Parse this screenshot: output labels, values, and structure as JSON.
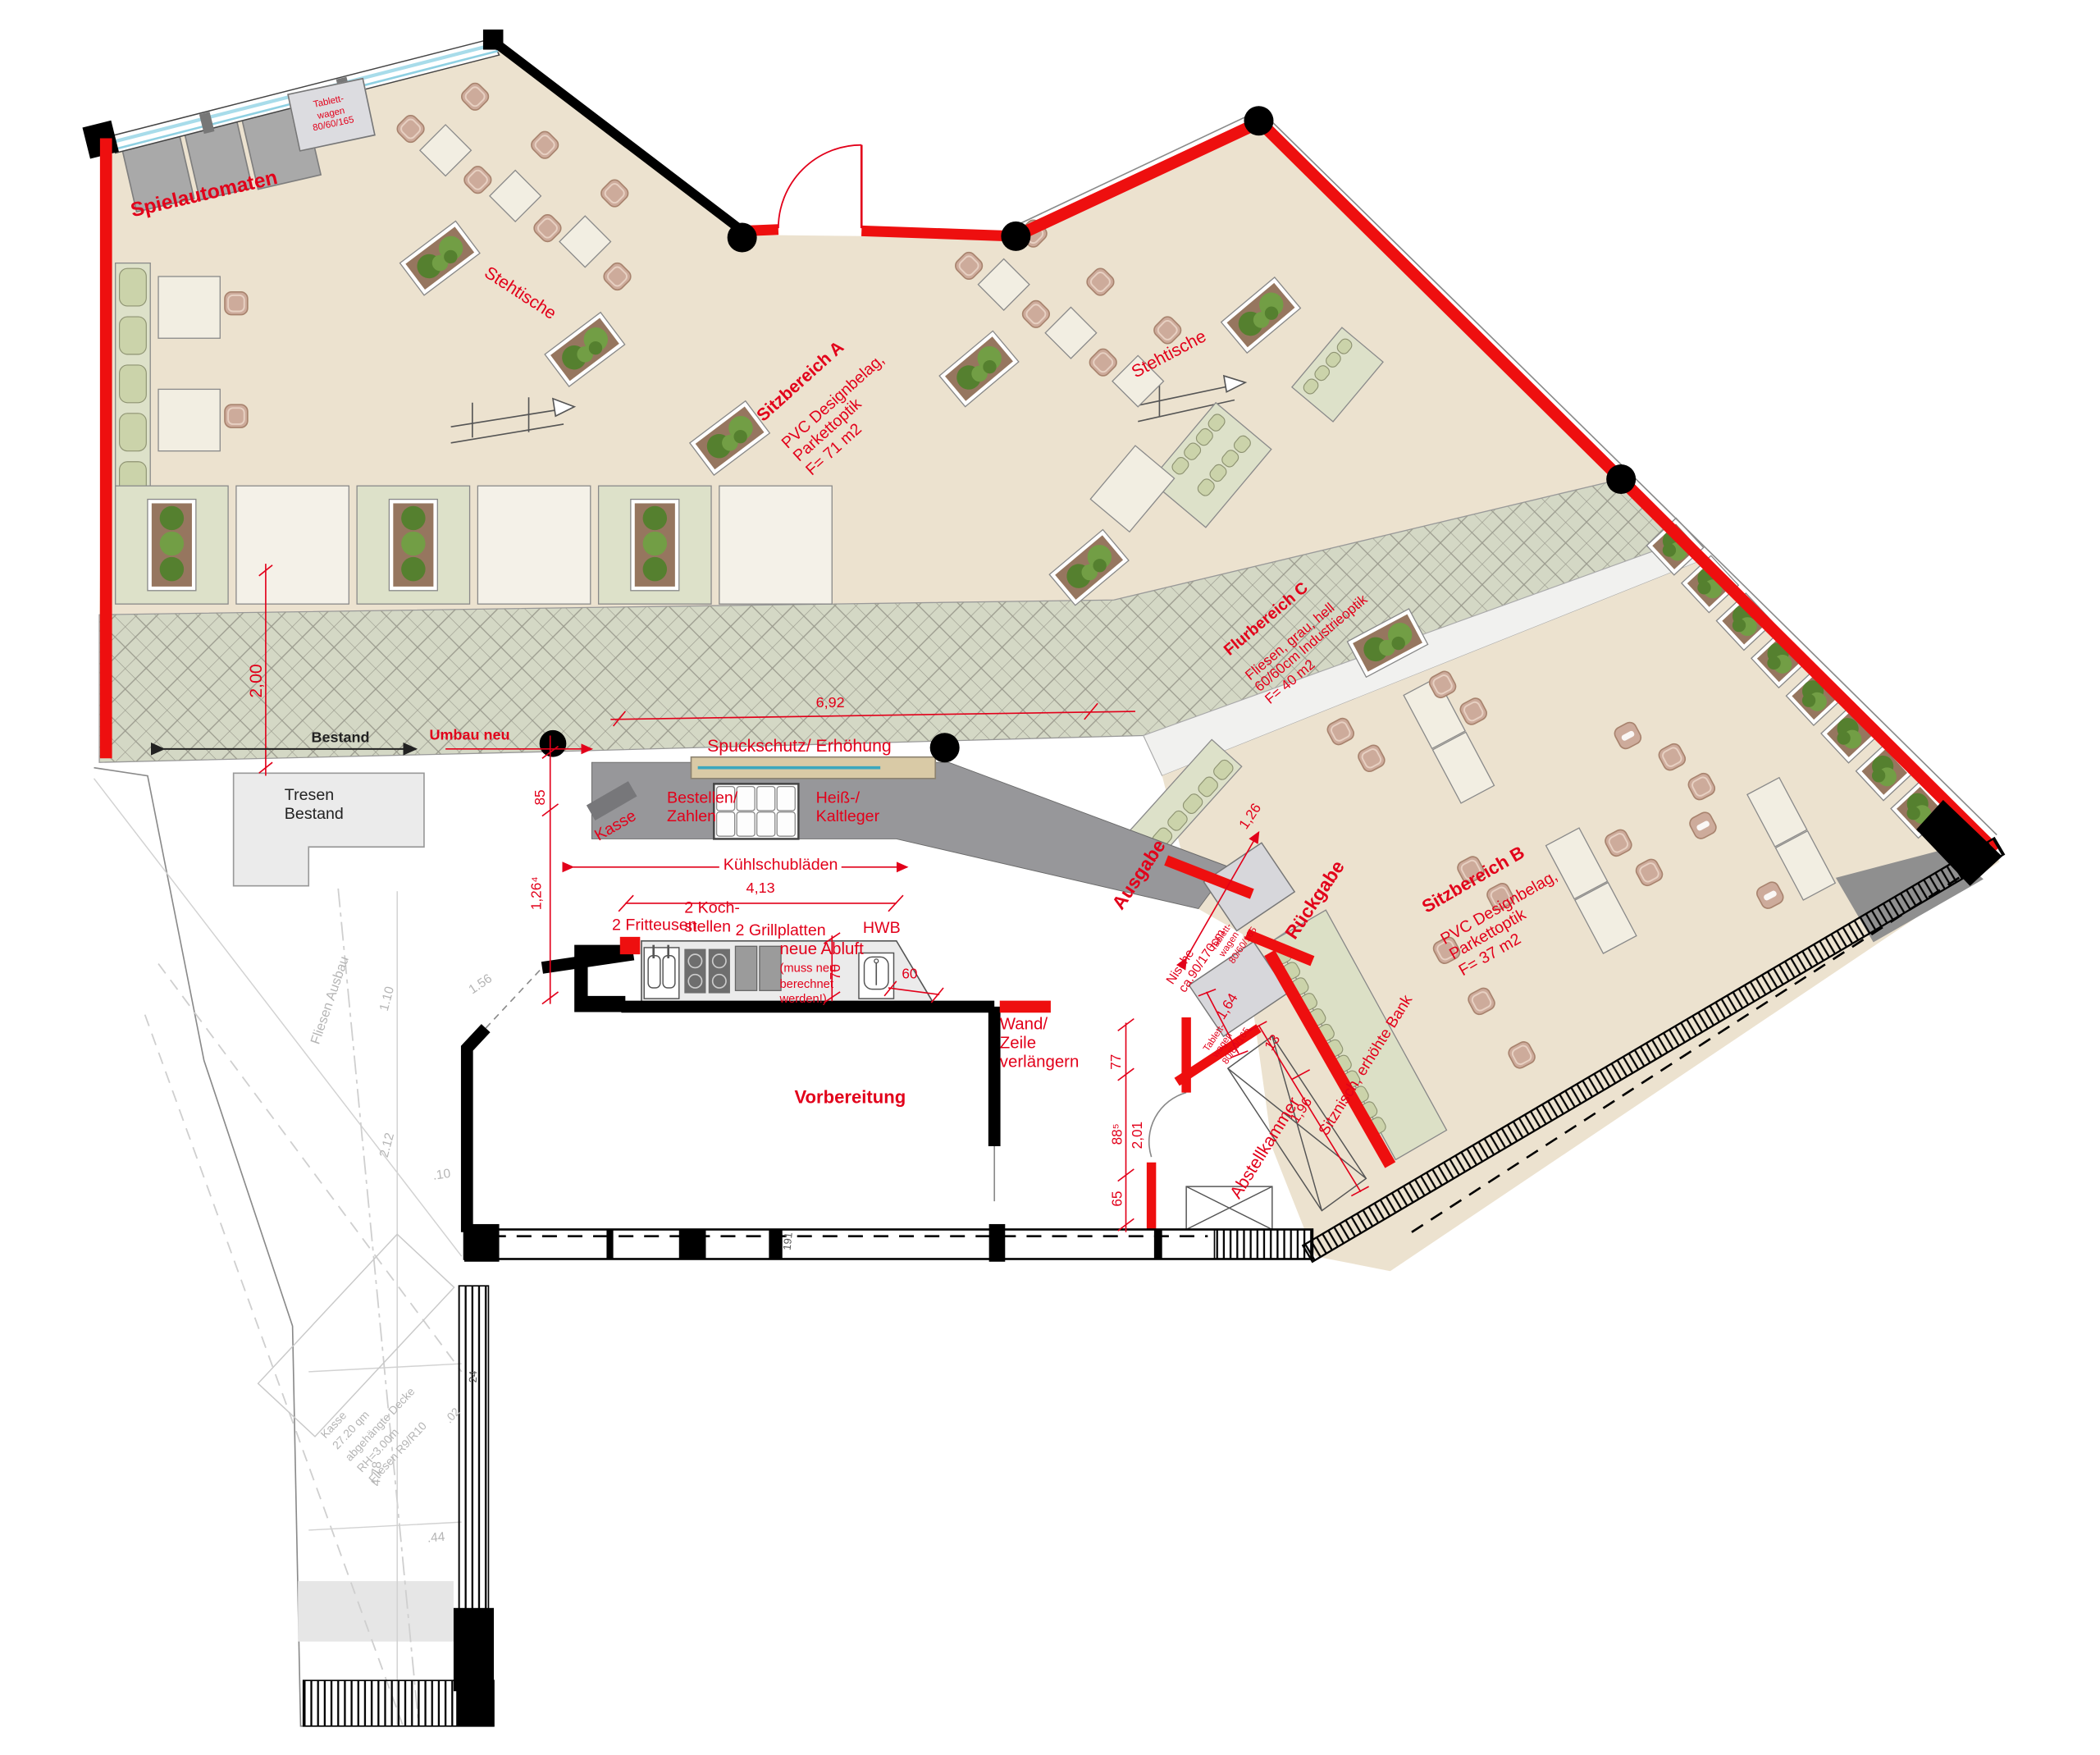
{
  "labels": {
    "spielautomaten": "Spielautomaten",
    "tablettwagen": "Tablett-\nwagen\n80/60/165",
    "stehtische": "Stehtische",
    "sitzbereich_a_title": "Sitzbereich A",
    "sitzbereich_a_body": "PVC Designbelag,\nParkettoptik\nF= 71 m2",
    "flurbereich_c_title": "Flurbereich C",
    "flurbereich_c_body": "Fliesen, grau, hell\n60/60cm Industrieoptik\nF= 40 m2",
    "sitzbereich_b_title": "Sitzbereich B",
    "sitzbereich_b_body": "PVC Designbelag,\nParkettoptik\nF= 37 m2",
    "spuckschutz": "Spuckschutz/ Erhöhung",
    "kasse": "Kasse",
    "bestellen_zahlen": "Bestellen/\nZahlen",
    "heiss_kaltleger": "Heiß-/\nKaltleger",
    "kuehlschubladen": "Kühlschubläden",
    "ausgabe": "Ausgabe",
    "rueckgabe": "Rückgabe",
    "nische": "Nische\nca.90/170cm",
    "fritteusen": "2 Fritteusen",
    "kochstellen": "2 Koch-\nstellen",
    "grillplatten": "2 Grillplatten",
    "hwb": "HWB",
    "neue_abluft": "neue Abluft",
    "abluft_hinweis": "(muss neu\nberechnet\nwerden!)",
    "wand_zeile": "Wand/\nZeile\nverlängern",
    "vorbereitung": "Vorbereitung",
    "abstellkammer": "Abstellkammer",
    "sitznische": "Sitznisch, erhöhte Bank",
    "tresen_bestand": "Tresen\nBestand",
    "bestand": "Bestand",
    "umbau_neu": "Umbau neu"
  },
  "dimensions": {
    "d_2_00": "2,00",
    "d_6_92": "6,92",
    "d_85": "85",
    "d_1_26_4": "1,26⁴",
    "d_4_13": "4,13",
    "d_70": "70",
    "d_60": "60",
    "d_77": "77",
    "d_88_5": "88⁵",
    "d_2_01": "2,01",
    "d_65": "65",
    "d_1_26": "1,26",
    "d_1_64": "1,64",
    "d_1_96": "1,96",
    "d_13": "13"
  },
  "bestand_annotationen": {
    "fliesen_ausbau": "Fliesen Ausbau",
    "d_1_10": "1.10",
    "d_2_12": "2.12",
    "d_1_56": "1.56",
    "d_0_10": ".10",
    "d_4_78": "4.78",
    "d_0_44": ".44",
    "d_24": "24",
    "d_191": "191",
    "kasse_block": "Kasse\n27.20 qm\nabgehängte Decke\nRH=3.00m\nFliesen R9/R10",
    "d_02": ".02"
  },
  "colors": {
    "accent_red": "#e2001a",
    "wall_red": "#ee0f0f",
    "floor_beige": "#ece2cf",
    "corridor_green": "#d4d8c5",
    "bench_green": "#cbd3aa",
    "counter_gray": "#97979a",
    "chair_pink": "#cdab9b",
    "spuckschutz_tan": "#d9caa6",
    "window_cyan": "#a8dcea"
  }
}
